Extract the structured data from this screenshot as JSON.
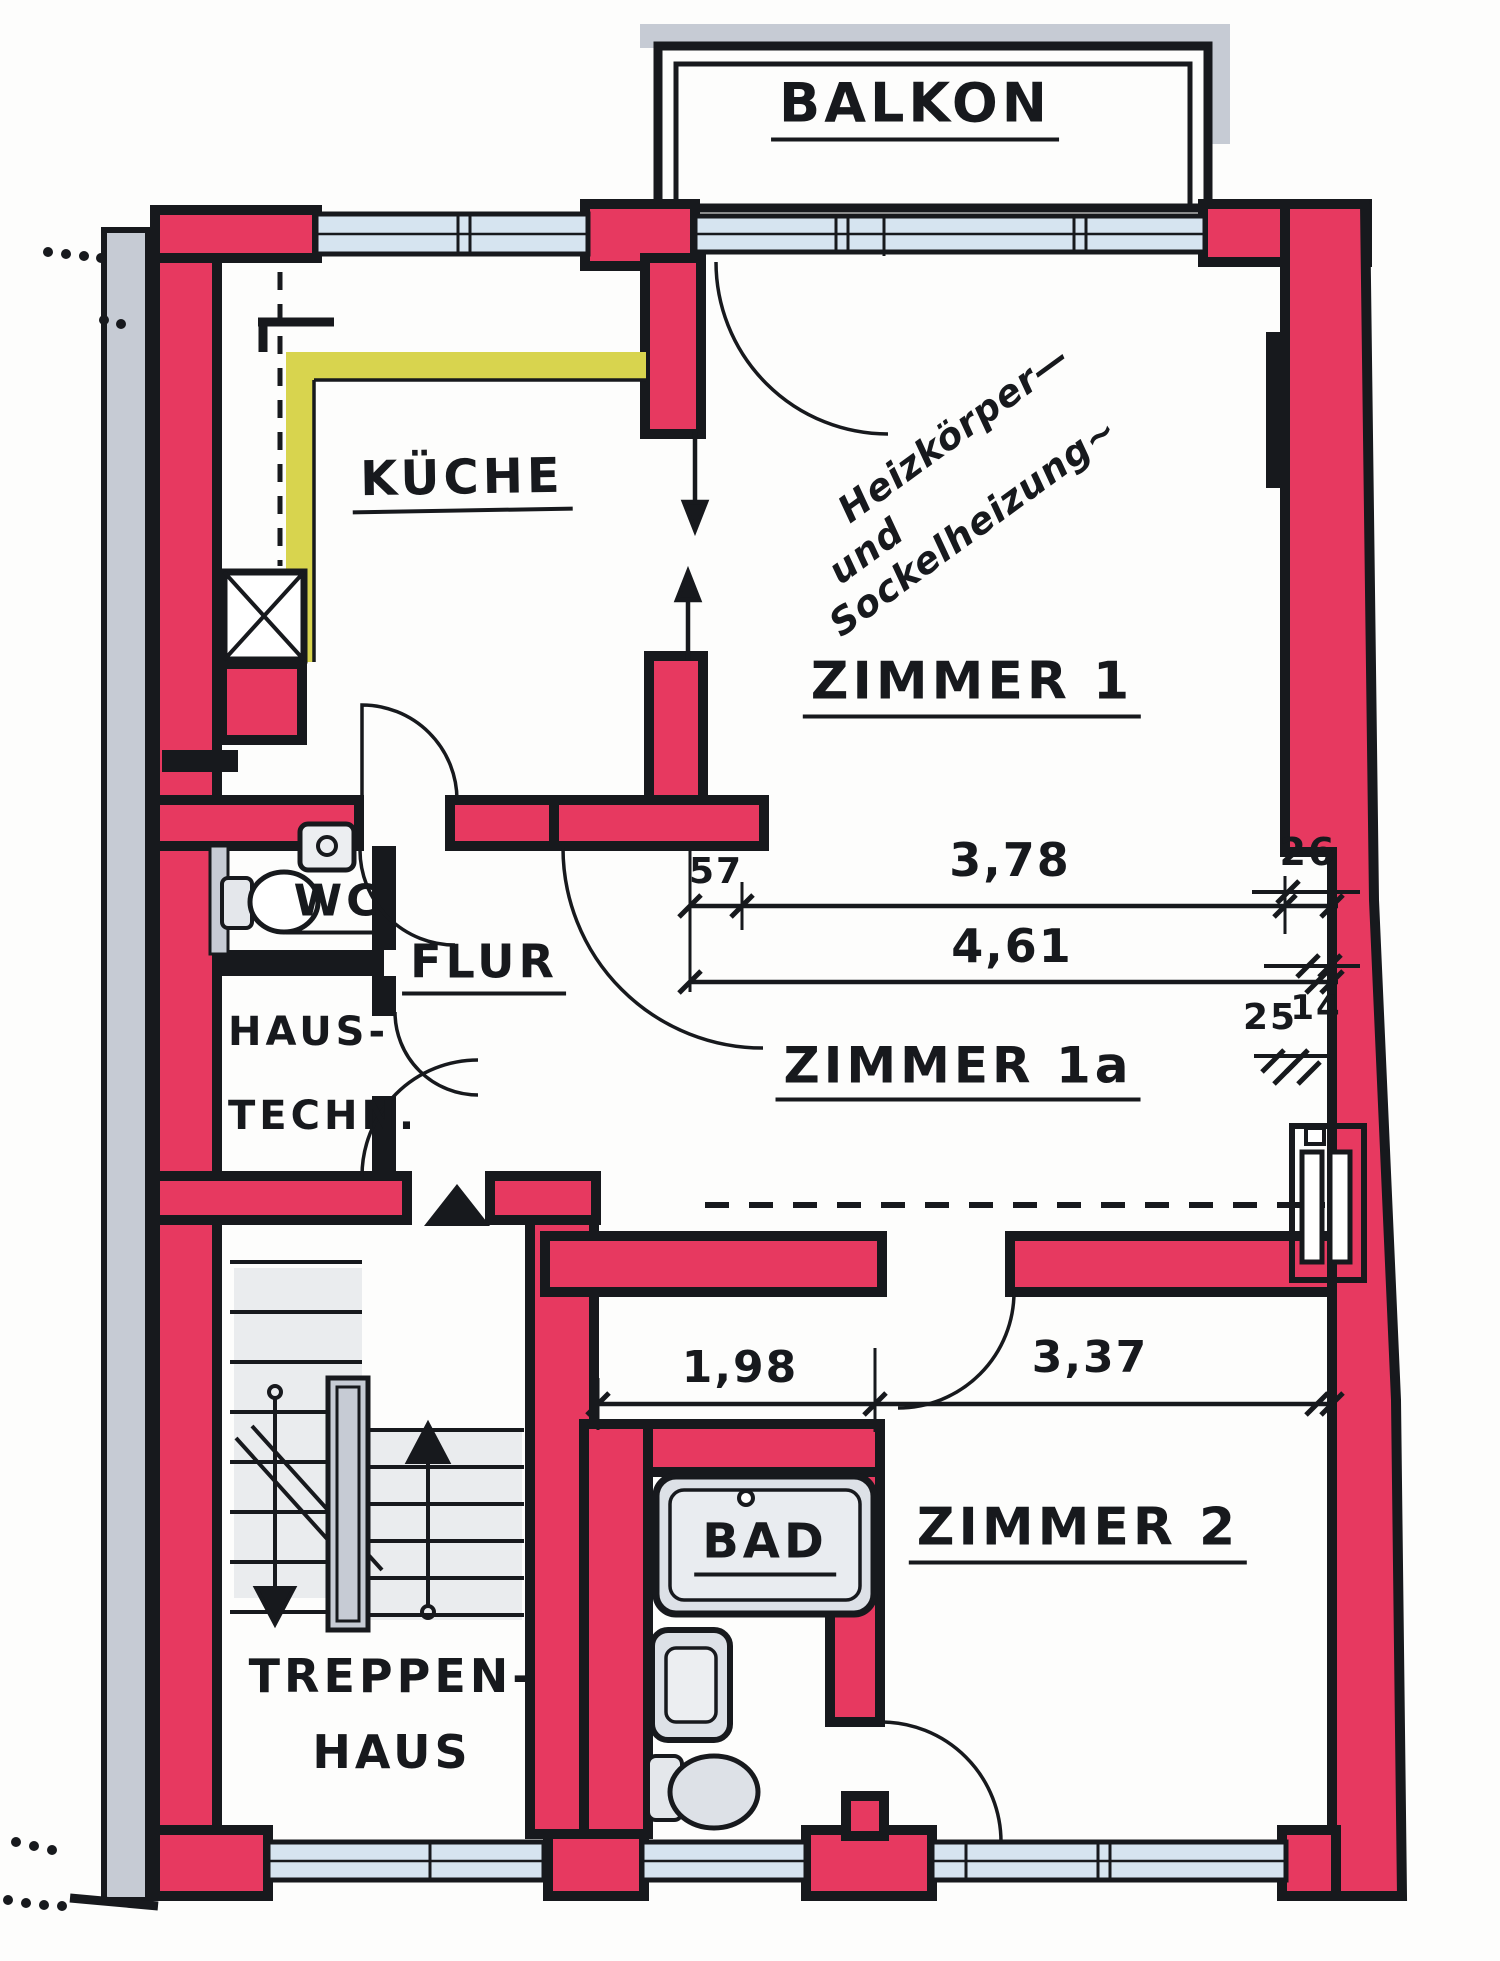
{
  "plan": {
    "balcony": {
      "label": "BALKON"
    },
    "rooms": {
      "kueche": {
        "label": "KÜCHE"
      },
      "zimmer1": {
        "label": "ZIMMER 1"
      },
      "zimmer1a": {
        "label": "ZIMMER 1a"
      },
      "zimmer2": {
        "label": "ZIMMER 2"
      },
      "wc": {
        "label": "WC"
      },
      "flur": {
        "label": "FLUR"
      },
      "haustechnik": {
        "label_line1": "HAUS-",
        "label_line2": "TECHN."
      },
      "treppenhaus": {
        "label_line1": "TREPPEN-",
        "label_line2": "HAUS"
      },
      "bad": {
        "label": "BAD"
      }
    },
    "annotation": {
      "line1": "Heizkörper—",
      "line2": "und",
      "line3": "Sockelheizung~"
    },
    "dimensions": {
      "zimmer1_chain": {
        "seg1": "57",
        "seg2": "3,78",
        "seg3": "26",
        "total": "4,61"
      },
      "right_wall": {
        "v1": "25",
        "v2": "14"
      },
      "lower_chain": {
        "seg1": "1,98",
        "seg2": "3,37"
      }
    },
    "colors": {
      "wall_red": "#e73960",
      "window_blue": "#d6e4f0",
      "counter_yellow": "#d8d44e",
      "fixture_gray": "#c6cbd4",
      "wash_gray": "#ccd2da",
      "ink": "#17191d"
    }
  }
}
